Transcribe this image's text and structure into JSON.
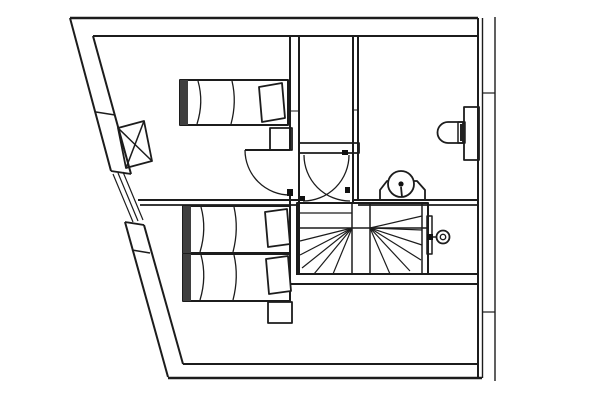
{
  "drawing": {
    "width": 600,
    "height": 400,
    "background": "#ffffff",
    "stroke": "#1c1c1c",
    "colors": {
      "line": "#1c1c1c",
      "dark_fill": "#111111",
      "shade": "#3f3f3f",
      "white": "#ffffff"
    },
    "description": "architectural-floor-plan-attic-storey-with-three-beds-winder-staircase-bathroom",
    "elements": [
      {
        "name": "top-wall",
        "shapes": [
          {
            "t": "l",
            "x1": 70,
            "y1": 18,
            "x2": 478,
            "y2": 18,
            "sw": 2.5
          },
          {
            "t": "l",
            "x1": 93,
            "y1": 36,
            "x2": 477,
            "y2": 36,
            "sw": 2
          }
        ]
      },
      {
        "name": "right-wall",
        "shapes": [
          {
            "t": "l",
            "x1": 478,
            "y1": 18,
            "x2": 478,
            "y2": 378,
            "sw": 2
          },
          {
            "t": "l",
            "x1": 482.5,
            "y1": 18,
            "x2": 482.5,
            "y2": 378,
            "sw": 1.4
          }
        ]
      },
      {
        "name": "roof-eaves-line",
        "shapes": [
          {
            "t": "l",
            "x1": 495,
            "y1": 17,
            "x2": 495,
            "y2": 381,
            "sw": 1.4
          },
          {
            "t": "l",
            "x1": 482,
            "y1": 93,
            "x2": 495,
            "y2": 93,
            "sw": 1.2
          },
          {
            "t": "l",
            "x1": 482,
            "y1": 312,
            "x2": 495,
            "y2": 312,
            "sw": 1.2
          }
        ]
      },
      {
        "name": "bottom-wall",
        "shapes": [
          {
            "t": "l",
            "x1": 168,
            "y1": 378,
            "x2": 482,
            "y2": 378,
            "sw": 2.5
          },
          {
            "t": "l",
            "x1": 183,
            "y1": 364,
            "x2": 478,
            "y2": 364,
            "sw": 2
          }
        ]
      },
      {
        "name": "slanted-west-wall-upper",
        "shapes": [
          {
            "t": "l",
            "x1": 70,
            "y1": 18,
            "x2": 111,
            "y2": 171,
            "sw": 2
          },
          {
            "t": "l",
            "x1": 93,
            "y1": 36,
            "x2": 131,
            "y2": 174,
            "sw": 2
          },
          {
            "t": "l",
            "x1": 111,
            "y1": 171,
            "x2": 131,
            "y2": 174,
            "sw": 1.8
          },
          {
            "t": "l",
            "x1": 96,
            "y1": 112,
            "x2": 115,
            "y2": 115,
            "sw": 1.5
          }
        ]
      },
      {
        "name": "west-window",
        "shapes": [
          {
            "t": "l",
            "x1": 113,
            "y1": 174,
            "x2": 133,
            "y2": 222,
            "sw": 1.2
          },
          {
            "t": "l",
            "x1": 118,
            "y1": 173,
            "x2": 138,
            "y2": 221,
            "sw": 1.2
          },
          {
            "t": "l",
            "x1": 123,
            "y1": 172,
            "x2": 143,
            "y2": 220,
            "sw": 1.2
          }
        ]
      },
      {
        "name": "slanted-west-wall-lower",
        "shapes": [
          {
            "t": "l",
            "x1": 125,
            "y1": 222,
            "x2": 168,
            "y2": 377,
            "sw": 2
          },
          {
            "t": "l",
            "x1": 144,
            "y1": 225,
            "x2": 183,
            "y2": 364,
            "sw": 2
          },
          {
            "t": "l",
            "x1": 125,
            "y1": 222,
            "x2": 144,
            "y2": 225,
            "sw": 1.8
          },
          {
            "t": "l",
            "x1": 132,
            "y1": 250,
            "x2": 150,
            "y2": 253,
            "sw": 1.5
          }
        ]
      },
      {
        "name": "bedroom-hall-partition-wall",
        "shapes": [
          {
            "t": "l",
            "x1": 290,
            "y1": 36,
            "x2": 290,
            "y2": 150,
            "sw": 2
          },
          {
            "t": "l",
            "x1": 290,
            "y1": 195,
            "x2": 290,
            "y2": 284,
            "sw": 2
          },
          {
            "t": "l",
            "x1": 299,
            "y1": 36,
            "x2": 299,
            "y2": 274,
            "sw": 2
          },
          {
            "t": "l",
            "x1": 290,
            "y1": 111,
            "x2": 299,
            "y2": 111,
            "sw": 1
          }
        ]
      },
      {
        "name": "hall-bathroom-partition-wall",
        "shapes": [
          {
            "t": "l",
            "x1": 353,
            "y1": 36,
            "x2": 353,
            "y2": 203,
            "sw": 2
          },
          {
            "t": "l",
            "x1": 358,
            "y1": 36,
            "x2": 358,
            "y2": 200,
            "sw": 2
          },
          {
            "t": "l",
            "x1": 353,
            "y1": 110,
            "x2": 358,
            "y2": 110,
            "sw": 1
          }
        ]
      },
      {
        "name": "hall-lintel-wall",
        "shapes": [
          {
            "t": "r",
            "x": 299,
            "y": 143,
            "w": 60,
            "h": 10,
            "sw": 1.8
          },
          {
            "t": "r",
            "x": 342,
            "y": 150,
            "w": 6,
            "h": 5,
            "f": "#111111",
            "ns": 1
          }
        ]
      },
      {
        "name": "bathroom-south-wall",
        "shapes": [
          {
            "t": "l",
            "x1": 353,
            "y1": 200,
            "x2": 478,
            "y2": 200,
            "sw": 2
          },
          {
            "t": "l",
            "x1": 358,
            "y1": 205,
            "x2": 478,
            "y2": 205,
            "sw": 1.8
          }
        ]
      },
      {
        "name": "bedrooms-partition-wall",
        "shapes": [
          {
            "t": "l",
            "x1": 138,
            "y1": 200,
            "x2": 299,
            "y2": 200,
            "sw": 2
          },
          {
            "t": "l",
            "x1": 140,
            "y1": 205,
            "x2": 299,
            "y2": 205,
            "sw": 1.8
          }
        ]
      },
      {
        "name": "under-stair-wall",
        "shapes": [
          {
            "t": "l",
            "x1": 296,
            "y1": 274,
            "x2": 478,
            "y2": 274,
            "sw": 2
          },
          {
            "t": "l",
            "x1": 290,
            "y1": 284,
            "x2": 479,
            "y2": 284,
            "sw": 2
          }
        ]
      },
      {
        "name": "staircase",
        "shapes": [
          {
            "t": "r",
            "x": 297,
            "y": 203,
            "w": 131,
            "h": 71,
            "sw": 2
          },
          {
            "t": "l",
            "x1": 422,
            "y1": 203,
            "x2": 422,
            "y2": 274,
            "sw": 1.5
          },
          {
            "t": "l",
            "x1": 352,
            "y1": 203,
            "x2": 352,
            "y2": 274,
            "sw": 1.5
          },
          {
            "t": "l",
            "x1": 370,
            "y1": 203,
            "x2": 370,
            "y2": 274,
            "sw": 1.5
          },
          {
            "t": "l",
            "x1": 300,
            "y1": 228,
            "x2": 428,
            "y2": 228,
            "sw": 1.5
          },
          {
            "t": "l",
            "x1": 300,
            "y1": 213,
            "x2": 352,
            "y2": 213,
            "sw": 1.2
          },
          {
            "t": "l",
            "x1": 352,
            "y1": 228,
            "x2": 300,
            "y2": 241,
            "sw": 1.2
          },
          {
            "t": "l",
            "x1": 352,
            "y1": 228,
            "x2": 300,
            "y2": 255,
            "sw": 1.2
          },
          {
            "t": "l",
            "x1": 352,
            "y1": 228,
            "x2": 302,
            "y2": 268,
            "sw": 1.2
          },
          {
            "t": "l",
            "x1": 352,
            "y1": 228,
            "x2": 314,
            "y2": 274,
            "sw": 1.2
          },
          {
            "t": "l",
            "x1": 352,
            "y1": 228,
            "x2": 333,
            "y2": 274,
            "sw": 1.2
          },
          {
            "t": "l",
            "x1": 370,
            "y1": 228,
            "x2": 422,
            "y2": 216,
            "sw": 1.2
          },
          {
            "t": "l",
            "x1": 370,
            "y1": 228,
            "x2": 422,
            "y2": 230,
            "sw": 1.2
          },
          {
            "t": "l",
            "x1": 370,
            "y1": 228,
            "x2": 422,
            "y2": 245,
            "sw": 1.2
          },
          {
            "t": "l",
            "x1": 370,
            "y1": 228,
            "x2": 421,
            "y2": 260,
            "sw": 1.2
          },
          {
            "t": "l",
            "x1": 370,
            "y1": 228,
            "x2": 410,
            "y2": 271,
            "sw": 1.2
          },
          {
            "t": "l",
            "x1": 370,
            "y1": 228,
            "x2": 390,
            "y2": 274,
            "sw": 1.2
          }
        ]
      },
      {
        "name": "bedroom-door",
        "shapes": [
          {
            "t": "l",
            "x1": 245,
            "y1": 150,
            "x2": 290,
            "y2": 150,
            "sw": 2
          },
          {
            "t": "p",
            "d": "M245,150 A45,45 0 0 0 290,195",
            "sw": 1.3
          },
          {
            "t": "r",
            "x": 287,
            "y": 189,
            "w": 6,
            "h": 7,
            "f": "#111111",
            "ns": 1
          }
        ]
      },
      {
        "name": "double-swing-door",
        "shapes": [
          {
            "t": "p",
            "d": "M304,155 A46,46 0 0 0 350,201",
            "sw": 1.3
          },
          {
            "t": "p",
            "d": "M349,155 A46,46 0 0 1 303,201",
            "sw": 1.3
          },
          {
            "t": "r",
            "x": 300,
            "y": 196,
            "w": 5,
            "h": 5,
            "f": "#111111",
            "ns": 1
          },
          {
            "t": "r",
            "x": 345,
            "y": 187,
            "w": 5,
            "h": 6,
            "f": "#111111",
            "ns": 1
          }
        ]
      },
      {
        "name": "corridor-door-with-handle",
        "shapes": [
          {
            "t": "r",
            "x": 427,
            "y": 216,
            "w": 5,
            "h": 38,
            "sw": 1.5
          },
          {
            "t": "r",
            "x": 427,
            "y": 234,
            "w": 6,
            "h": 6,
            "f": "#111111",
            "ns": 1
          },
          {
            "t": "l",
            "x1": 433,
            "y1": 237,
            "x2": 437,
            "y2": 237,
            "sw": 1.5
          },
          {
            "t": "c",
            "cx": 443,
            "cy": 237,
            "r": 6.5,
            "sw": 1.8
          },
          {
            "t": "c",
            "cx": 443,
            "cy": 237,
            "r": 2.7,
            "sw": 1.4
          }
        ]
      },
      {
        "name": "toilet",
        "shapes": [
          {
            "t": "r",
            "x": 464,
            "y": 107,
            "w": 15,
            "h": 53,
            "sw": 1.8
          },
          {
            "t": "p",
            "d": "M463,122 L448,122 A10.5,10.5 0 0 0 448,143 L463,143 Z",
            "sw": 1.8
          },
          {
            "t": "r",
            "x": 458,
            "y": 122,
            "w": 7,
            "h": 21,
            "sw": 1.5
          },
          {
            "t": "r",
            "x": 460,
            "y": 124,
            "w": 5,
            "h": 17,
            "f": "#222222",
            "ns": 1
          }
        ]
      },
      {
        "name": "washbasin",
        "shapes": [
          {
            "t": "p",
            "d": "M380,200 L380,190 L387,181 L417,181 L425,190 L425,200 Z",
            "sw": 1.8
          },
          {
            "t": "c",
            "cx": 401,
            "cy": 184,
            "r": 13,
            "sw": 1.8,
            "f": "#ffffff"
          },
          {
            "t": "c",
            "cx": 401,
            "cy": 184,
            "r": 2.6,
            "f": "#111111",
            "ns": 1
          },
          {
            "t": "l",
            "x1": 401,
            "y1": 187,
            "x2": 402,
            "y2": 197,
            "sw": 1.8
          }
        ]
      },
      {
        "name": "bed-single-top",
        "shapes": [
          {
            "t": "r",
            "x": 180,
            "y": 80,
            "w": 108,
            "h": 45,
            "sw": 2
          },
          {
            "t": "r",
            "x": 180,
            "y": 80,
            "w": 8,
            "h": 45,
            "f": "#3f3f3f",
            "ns": 1
          },
          {
            "t": "p",
            "d": "M198,81 Q204,102 197,124",
            "sw": 1.3
          },
          {
            "t": "p",
            "d": "M232,81 Q237,102 231,124",
            "sw": 1.3
          },
          {
            "t": "pg",
            "pts": "259,87 282,83 285,118 262,122",
            "sw": 1.8,
            "f": "#ffffff"
          }
        ]
      },
      {
        "name": "bed-single-middle",
        "shapes": [
          {
            "t": "r",
            "x": 183,
            "y": 206,
            "w": 107,
            "h": 47,
            "sw": 2
          },
          {
            "t": "r",
            "x": 183,
            "y": 206,
            "w": 8,
            "h": 47,
            "f": "#3f3f3f",
            "ns": 1
          },
          {
            "t": "p",
            "d": "M201,207 Q207,229 200,252",
            "sw": 1.3
          },
          {
            "t": "p",
            "d": "M234,207 Q239,229 233,252",
            "sw": 1.3
          },
          {
            "t": "pg",
            "pts": "265,212 287,209 290,244 268,247",
            "sw": 1.8,
            "f": "#ffffff"
          }
        ]
      },
      {
        "name": "bed-single-bottom",
        "shapes": [
          {
            "t": "r",
            "x": 183,
            "y": 254,
            "w": 107,
            "h": 47,
            "sw": 2
          },
          {
            "t": "r",
            "x": 183,
            "y": 254,
            "w": 8,
            "h": 47,
            "f": "#3f3f3f",
            "ns": 1
          },
          {
            "t": "p",
            "d": "M201,255 Q207,277 200,300",
            "sw": 1.3
          },
          {
            "t": "p",
            "d": "M234,255 Q239,277 233,300",
            "sw": 1.3
          },
          {
            "t": "pg",
            "pts": "266,259 288,256 291,291 269,294",
            "sw": 1.8,
            "f": "#ffffff"
          }
        ]
      },
      {
        "name": "nightstand",
        "shapes": [
          {
            "t": "r",
            "x": 268,
            "y": 302,
            "w": 24,
            "h": 21,
            "sw": 1.8
          }
        ]
      },
      {
        "name": "bedroom-cabinet",
        "shapes": [
          {
            "t": "r",
            "x": 270,
            "y": 128,
            "w": 22,
            "h": 22,
            "sw": 1.8
          }
        ]
      },
      {
        "name": "chimney-flue",
        "shapes": [
          {
            "t": "pg",
            "pts": "118,128 144,121 152,161 126,168",
            "sw": 1.8
          },
          {
            "t": "l",
            "x1": 118,
            "y1": 128,
            "x2": 152,
            "y2": 161,
            "sw": 1.5
          },
          {
            "t": "l",
            "x1": 144,
            "y1": 121,
            "x2": 126,
            "y2": 168,
            "sw": 1.5
          }
        ]
      }
    ]
  }
}
